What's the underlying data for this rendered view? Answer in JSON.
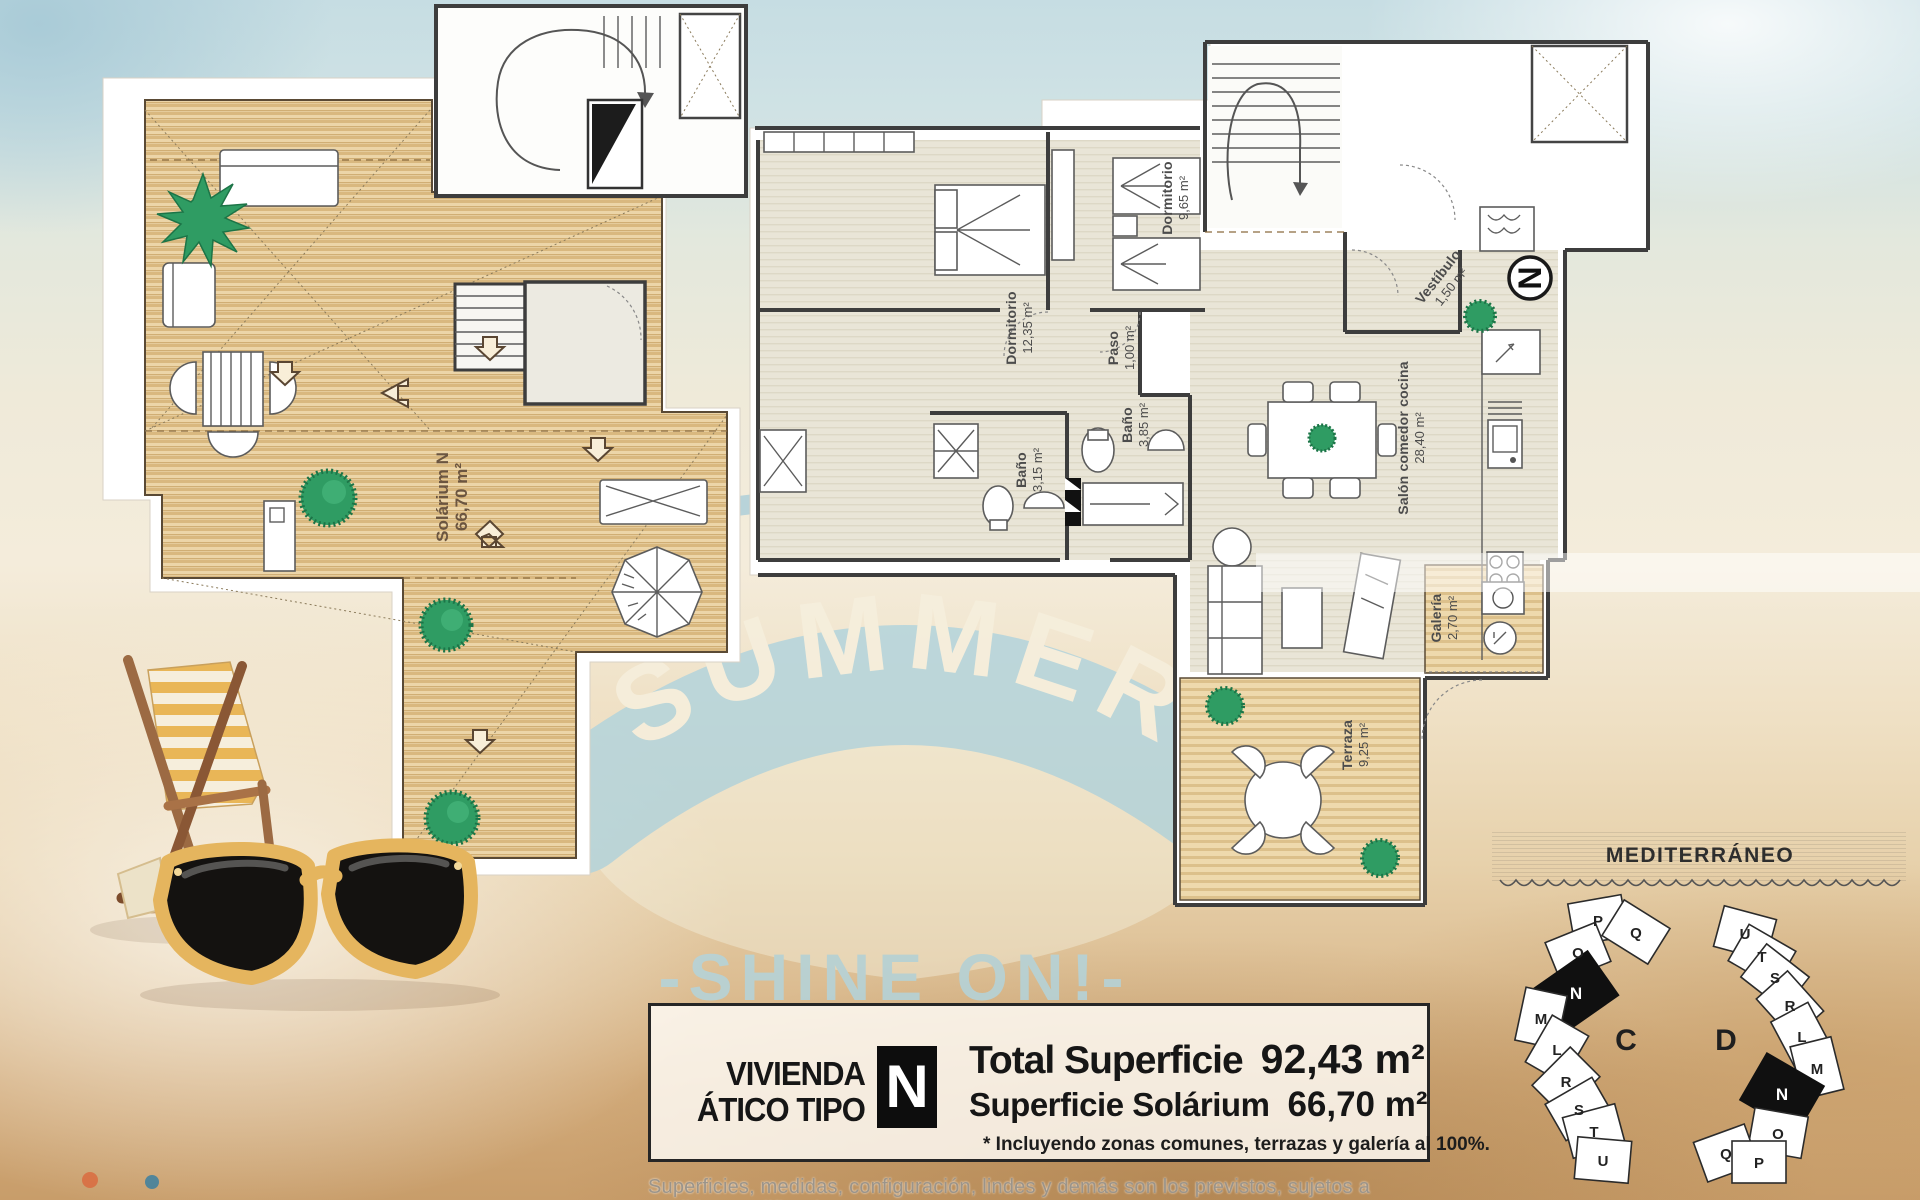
{
  "watermark": {
    "script": "Hello",
    "arc": "SUMMER",
    "tagline": "-SHINE ON!-"
  },
  "plans": {
    "solarium": {
      "name": "Solárium N",
      "area": "66,70 m²"
    },
    "apartment": {
      "compass": "N",
      "rooms": [
        {
          "name": "Dormitorio",
          "area": "12,35 m²"
        },
        {
          "name": "Dormitorio",
          "area": "9,65 m²"
        },
        {
          "name": "Paso",
          "area": "1,00 m²"
        },
        {
          "name": "Baño",
          "area": "3,15 m²"
        },
        {
          "name": "Baño",
          "area": "3,85 m²"
        },
        {
          "name": "Salón comedor cocina",
          "area": "28,40 m²"
        },
        {
          "name": "Vestíbulo",
          "area": "1,50 m²"
        },
        {
          "name": "Galería",
          "area": "2,70 m²"
        },
        {
          "name": "Terraza",
          "area": "9,25 m²"
        }
      ]
    }
  },
  "info_box": {
    "title_line1": "VIVIENDA",
    "title_line2": "ÁTICO TIPO",
    "type_letter": "N",
    "total_label": "Total Superficie",
    "total_value": "92,43 m²",
    "solarium_label": "Superficie Solárium",
    "solarium_value": "66,70 m²",
    "footnote": "* Incluyendo zonas comunes, terrazas y galería al 100%."
  },
  "site_plan": {
    "sea_label": "MEDITERRÁNEO",
    "block_c_label": "C",
    "block_d_label": "D",
    "block_c_units": [
      "P",
      "Q",
      "O",
      "N",
      "M",
      "L",
      "R",
      "S",
      "T",
      "U"
    ],
    "block_d_units": [
      "U",
      "T",
      "S",
      "R",
      "L",
      "M",
      "N",
      "O",
      "Q",
      "P"
    ],
    "highlighted_unit": "N"
  },
  "disclaimer": "Superficies, medidas, configuración, lindes y demás son los previstos, sujetos a posibles modificaciones por",
  "colors": {
    "watermark_blue": "#b3d4dc",
    "deck_wood": "#e9d1a4",
    "deck_stripe": "#d2ae78",
    "apartment_floor": "#e8e4d6",
    "terrace_wood": "#e8cf9e",
    "plan_wall": "#3d3d3d",
    "accent_green": "#2f9c63",
    "highlight_unit": "#101010",
    "sunglasses_frame": "#e5b55e",
    "chair_wood": "#9c6a43"
  }
}
